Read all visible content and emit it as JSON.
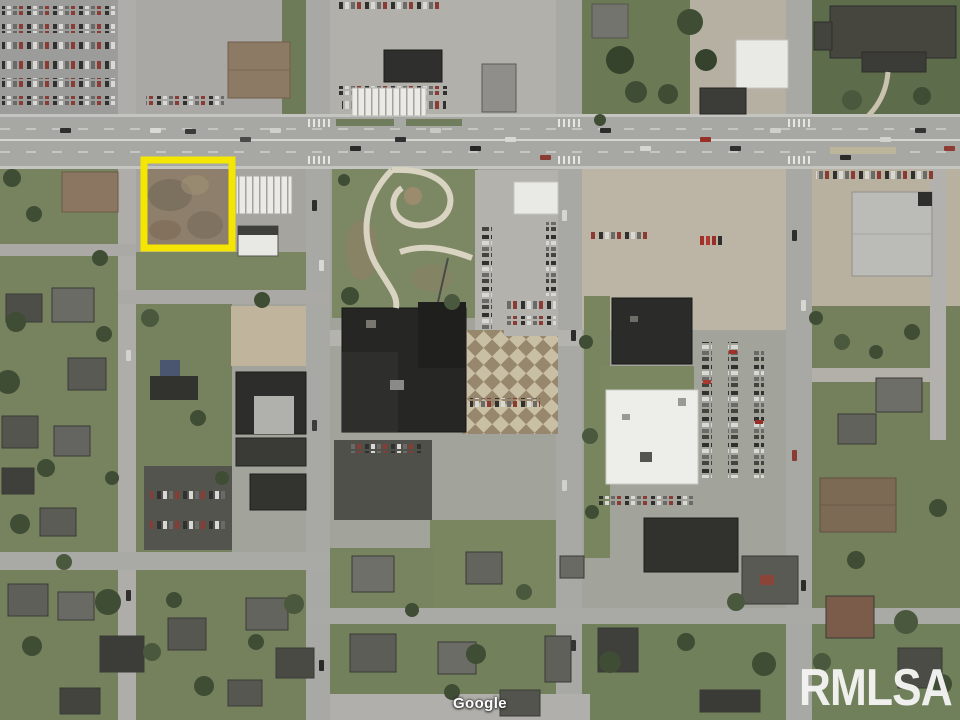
{
  "map": {
    "view": "satellite",
    "attribution": "Google",
    "watermark": "RMLSA",
    "parcel_highlight": {
      "color": "#F5E602",
      "shape": "rectangle"
    }
  }
}
